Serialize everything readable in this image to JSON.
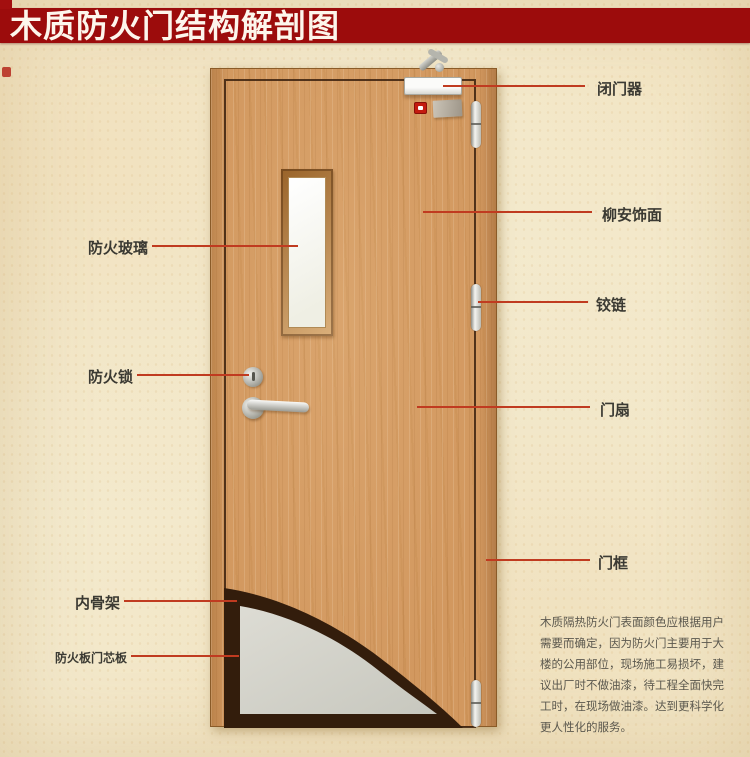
{
  "title": "木质防火门结构解剖图",
  "left_labels": [
    {
      "text": "防火玻璃"
    },
    {
      "text": "防火锁"
    },
    {
      "text": "内骨架"
    },
    {
      "text": "防火板门芯板"
    }
  ],
  "right_labels": [
    {
      "text": "闭门器"
    },
    {
      "text": "柳安饰面"
    },
    {
      "text": "铰链"
    },
    {
      "text": "门扇"
    },
    {
      "text": "门框"
    }
  ],
  "note_lines": [
    "木质隔热防火门表面颜色应根据用户",
    "需要而确定，因为防火门主要用于大",
    "楼的公用部位，现场施工易损坏，建",
    "议出厂时不做油漆，待工程全面快完",
    "工时，在现场做油漆。达到更科学化",
    "更人性化的服务。"
  ],
  "colors": {
    "banner_red": "#9c0c0c",
    "leader_line_red": "#c03b20",
    "door_wood": "#d2985f",
    "core_board_gray": "#d7d7cf",
    "inner_skeleton_dark": "#331d0c",
    "label_text": "#3b3a33"
  }
}
